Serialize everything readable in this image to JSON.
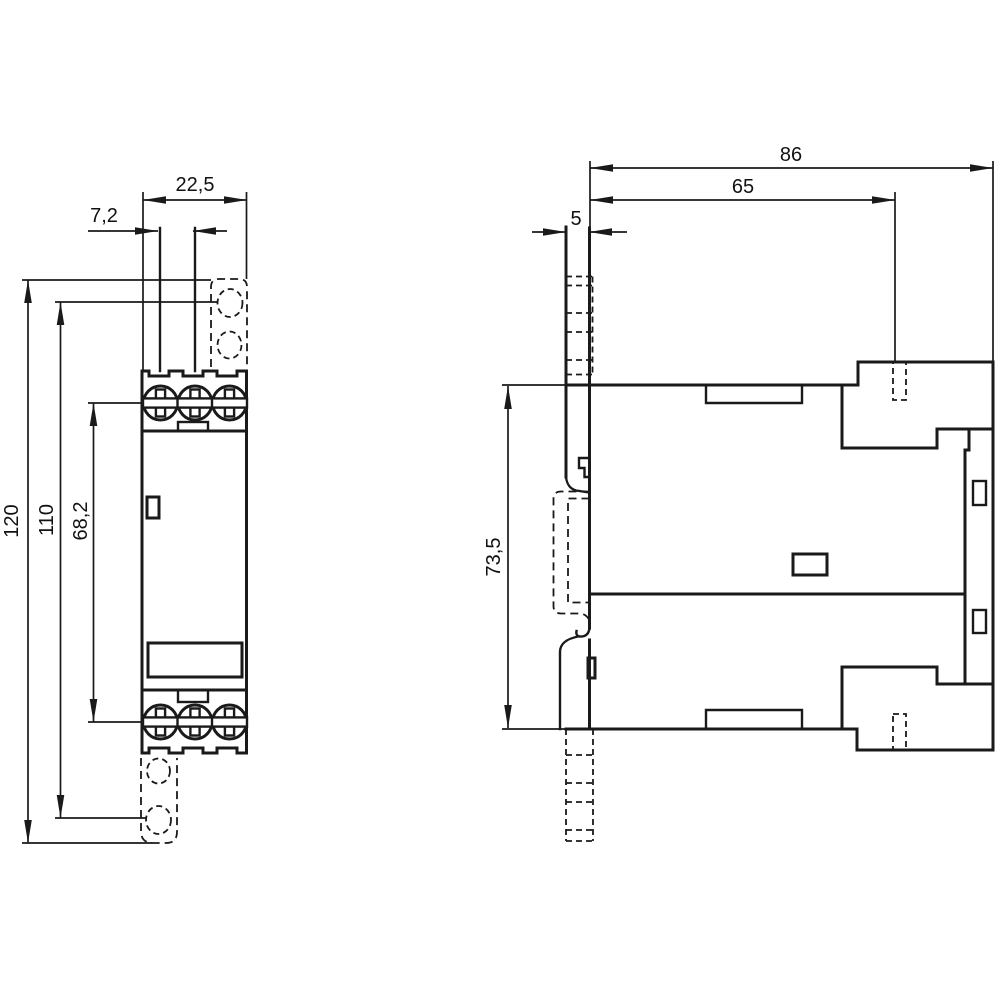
{
  "drawing": {
    "colors": {
      "background": "#ffffff",
      "line": "#1a1a1a"
    },
    "front": {
      "width": "22,5",
      "pitch": "7,2",
      "height": "120",
      "clip_height": "110",
      "screw_span": "68,2"
    },
    "side": {
      "depth": "86",
      "body_depth": "65",
      "strip_depth": "5",
      "height": "73,5"
    }
  }
}
